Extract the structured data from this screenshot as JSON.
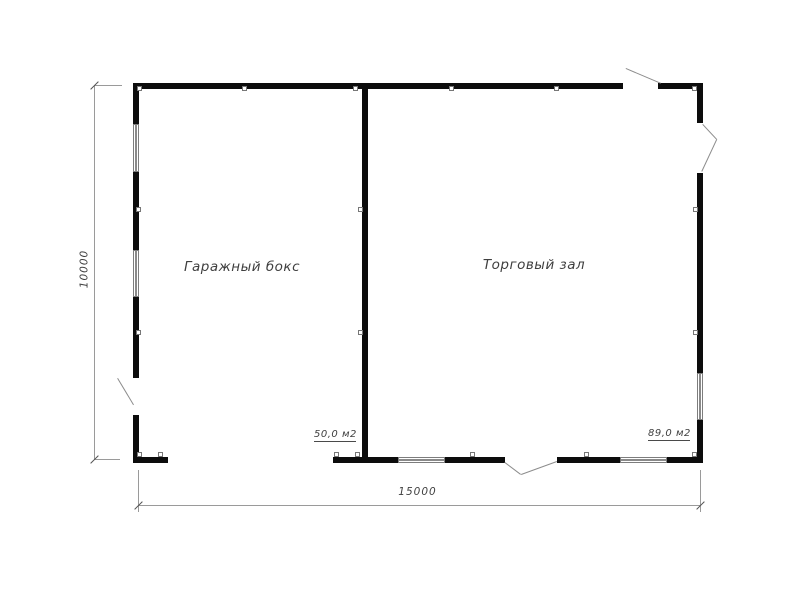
{
  "plan": {
    "rooms": [
      {
        "name": "Гаражный бокс",
        "area": "50,0 м2"
      },
      {
        "name": "Торговый зал",
        "area": "89,0 м2"
      }
    ],
    "dimensions": {
      "overall_width": "15000",
      "overall_height": "10000"
    }
  },
  "colors": {
    "wall": "#0c0c0c",
    "thin_line": "#9a9a9a",
    "text": "#3f3f3f",
    "background": "#ffffff"
  }
}
